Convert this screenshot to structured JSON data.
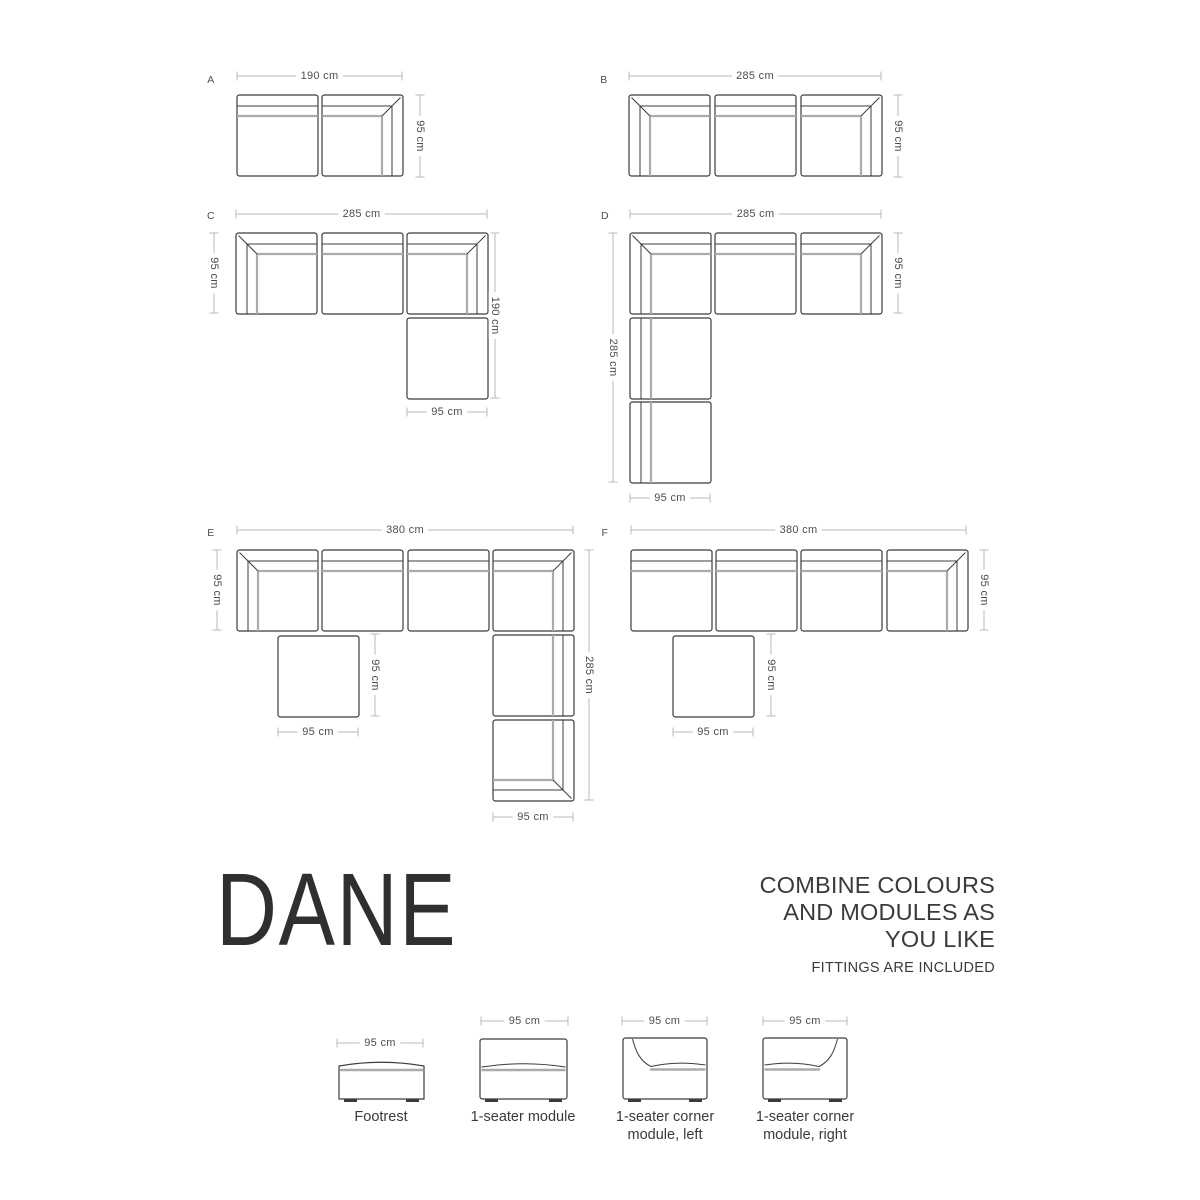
{
  "canvas": {
    "width": 1200,
    "height": 1200,
    "background": "#ffffff"
  },
  "palette": {
    "outline": "#3c3c3c",
    "cushion_line": "#ababab",
    "dim_line": "#b8b8b8",
    "dim_text": "#4d4d4d",
    "label_text": "#4d4d4d",
    "title_text": "#2f2f2f",
    "body_text": "#3a3a3a"
  },
  "module_size": 81,
  "configurations": [
    {
      "id": "A",
      "label": "A",
      "label_x": 211,
      "label_y": 80,
      "modules": [
        {
          "type": "seat-top",
          "x": 237,
          "y": 95
        },
        {
          "type": "corner-tr",
          "x": 322,
          "y": 95
        }
      ],
      "dims": [
        {
          "text": "190 cm",
          "dir": "h",
          "y": 76,
          "x1": 237,
          "x2": 402
        },
        {
          "text": "95 cm",
          "dir": "v",
          "x": 420,
          "y1": 95,
          "y2": 177
        }
      ]
    },
    {
      "id": "B",
      "label": "B",
      "label_x": 604,
      "label_y": 80,
      "modules": [
        {
          "type": "corner-tl",
          "x": 629,
          "y": 95
        },
        {
          "type": "seat-top",
          "x": 715,
          "y": 95
        },
        {
          "type": "corner-tr",
          "x": 801,
          "y": 95
        }
      ],
      "dims": [
        {
          "text": "285 cm",
          "dir": "h",
          "y": 76,
          "x1": 629,
          "x2": 881
        },
        {
          "text": "95 cm",
          "dir": "v",
          "x": 898,
          "y1": 95,
          "y2": 177
        }
      ]
    },
    {
      "id": "C",
      "label": "C",
      "label_x": 211,
      "label_y": 216,
      "modules": [
        {
          "type": "corner-tl",
          "x": 236,
          "y": 233
        },
        {
          "type": "seat-top",
          "x": 322,
          "y": 233
        },
        {
          "type": "corner-tr",
          "x": 407,
          "y": 233
        },
        {
          "type": "footrest",
          "x": 407,
          "y": 318
        }
      ],
      "dims": [
        {
          "text": "285 cm",
          "dir": "h",
          "y": 214,
          "x1": 236,
          "x2": 487
        },
        {
          "text": "95 cm",
          "dir": "v",
          "x": 214,
          "y1": 233,
          "y2": 313
        },
        {
          "text": "190 cm",
          "dir": "v",
          "x": 495,
          "y1": 233,
          "y2": 398
        },
        {
          "text": "95 cm",
          "dir": "h",
          "y": 412,
          "x1": 407,
          "x2": 487
        }
      ]
    },
    {
      "id": "D",
      "label": "D",
      "label_x": 605,
      "label_y": 216,
      "modules": [
        {
          "type": "corner-tl",
          "x": 630,
          "y": 233
        },
        {
          "type": "seat-top",
          "x": 715,
          "y": 233
        },
        {
          "type": "corner-tr",
          "x": 801,
          "y": 233
        },
        {
          "type": "seat-left",
          "x": 630,
          "y": 318
        },
        {
          "type": "seat-left",
          "x": 630,
          "y": 402
        }
      ],
      "dims": [
        {
          "text": "285 cm",
          "dir": "h",
          "y": 214,
          "x1": 630,
          "x2": 881
        },
        {
          "text": "95 cm",
          "dir": "v",
          "x": 898,
          "y1": 233,
          "y2": 313
        },
        {
          "text": "285 cm",
          "dir": "v",
          "x": 613,
          "y1": 233,
          "y2": 482
        },
        {
          "text": "95 cm",
          "dir": "h",
          "y": 498,
          "x1": 630,
          "x2": 710
        }
      ]
    },
    {
      "id": "E",
      "label": "E",
      "label_x": 211,
      "label_y": 533,
      "modules": [
        {
          "type": "corner-tl",
          "x": 237,
          "y": 550
        },
        {
          "type": "seat-top",
          "x": 322,
          "y": 550
        },
        {
          "type": "seat-top",
          "x": 408,
          "y": 550
        },
        {
          "type": "corner-tr",
          "x": 493,
          "y": 550
        },
        {
          "type": "footrest",
          "x": 278,
          "y": 636
        },
        {
          "type": "seat-right",
          "x": 493,
          "y": 635
        },
        {
          "type": "corner-br",
          "x": 493,
          "y": 720
        }
      ],
      "dims": [
        {
          "text": "380 cm",
          "dir": "h",
          "y": 530,
          "x1": 237,
          "x2": 573
        },
        {
          "text": "95 cm",
          "dir": "v",
          "x": 217,
          "y1": 550,
          "y2": 630
        },
        {
          "text": "95 cm",
          "dir": "v",
          "x": 375,
          "y1": 634,
          "y2": 716
        },
        {
          "text": "95 cm",
          "dir": "h",
          "y": 732,
          "x1": 278,
          "x2": 358
        },
        {
          "text": "285 cm",
          "dir": "v",
          "x": 589,
          "y1": 550,
          "y2": 800
        },
        {
          "text": "95 cm",
          "dir": "h",
          "y": 817,
          "x1": 493,
          "x2": 573
        }
      ]
    },
    {
      "id": "F",
      "label": "F",
      "label_x": 605,
      "label_y": 533,
      "modules": [
        {
          "type": "seat-top",
          "x": 631,
          "y": 550
        },
        {
          "type": "seat-top",
          "x": 716,
          "y": 550
        },
        {
          "type": "seat-top",
          "x": 801,
          "y": 550
        },
        {
          "type": "corner-tr",
          "x": 887,
          "y": 550
        },
        {
          "type": "footrest",
          "x": 673,
          "y": 636
        }
      ],
      "dims": [
        {
          "text": "380 cm",
          "dir": "h",
          "y": 530,
          "x1": 631,
          "x2": 966
        },
        {
          "text": "95 cm",
          "dir": "v",
          "x": 984,
          "y1": 550,
          "y2": 630
        },
        {
          "text": "95 cm",
          "dir": "v",
          "x": 771,
          "y1": 634,
          "y2": 716
        },
        {
          "text": "95 cm",
          "dir": "h",
          "y": 732,
          "x1": 673,
          "x2": 753
        }
      ]
    }
  ],
  "branding": {
    "title": "DANE",
    "tagline_lines": [
      "COMBINE COLOURS",
      "AND MODULES AS",
      "YOU LIKE"
    ],
    "note": "FITTINGS ARE INCLUDED"
  },
  "legend": {
    "items": [
      {
        "name": "footrest",
        "type": "footrest",
        "dim": {
          "text": "95 cm",
          "dir": "h",
          "y": 1043,
          "x1": 337,
          "x2": 423
        },
        "body": {
          "x1": 339,
          "x2": 424,
          "top": 1063,
          "bottom": 1099
        },
        "label_lines": [
          "Footrest"
        ]
      },
      {
        "name": "seater",
        "type": "seater",
        "dim": {
          "text": "95 cm",
          "dir": "h",
          "y": 1021,
          "x1": 481,
          "x2": 568
        },
        "body": {
          "x1": 480,
          "x2": 567,
          "top": 1039,
          "bottom": 1099
        },
        "label_lines": [
          "1-seater module"
        ]
      },
      {
        "name": "corner-left",
        "type": "corner-left",
        "dim": {
          "text": "95 cm",
          "dir": "h",
          "y": 1021,
          "x1": 622,
          "x2": 707
        },
        "body": {
          "x1": 623,
          "x2": 707,
          "top": 1038,
          "bottom": 1099
        },
        "label_lines": [
          "1-seater corner",
          "module, left"
        ]
      },
      {
        "name": "corner-right",
        "type": "corner-right",
        "dim": {
          "text": "95 cm",
          "dir": "h",
          "y": 1021,
          "x1": 763,
          "x2": 847
        },
        "body": {
          "x1": 763,
          "x2": 847,
          "top": 1038,
          "bottom": 1099
        },
        "label_lines": [
          "1-seater corner",
          "module, right"
        ]
      }
    ]
  }
}
